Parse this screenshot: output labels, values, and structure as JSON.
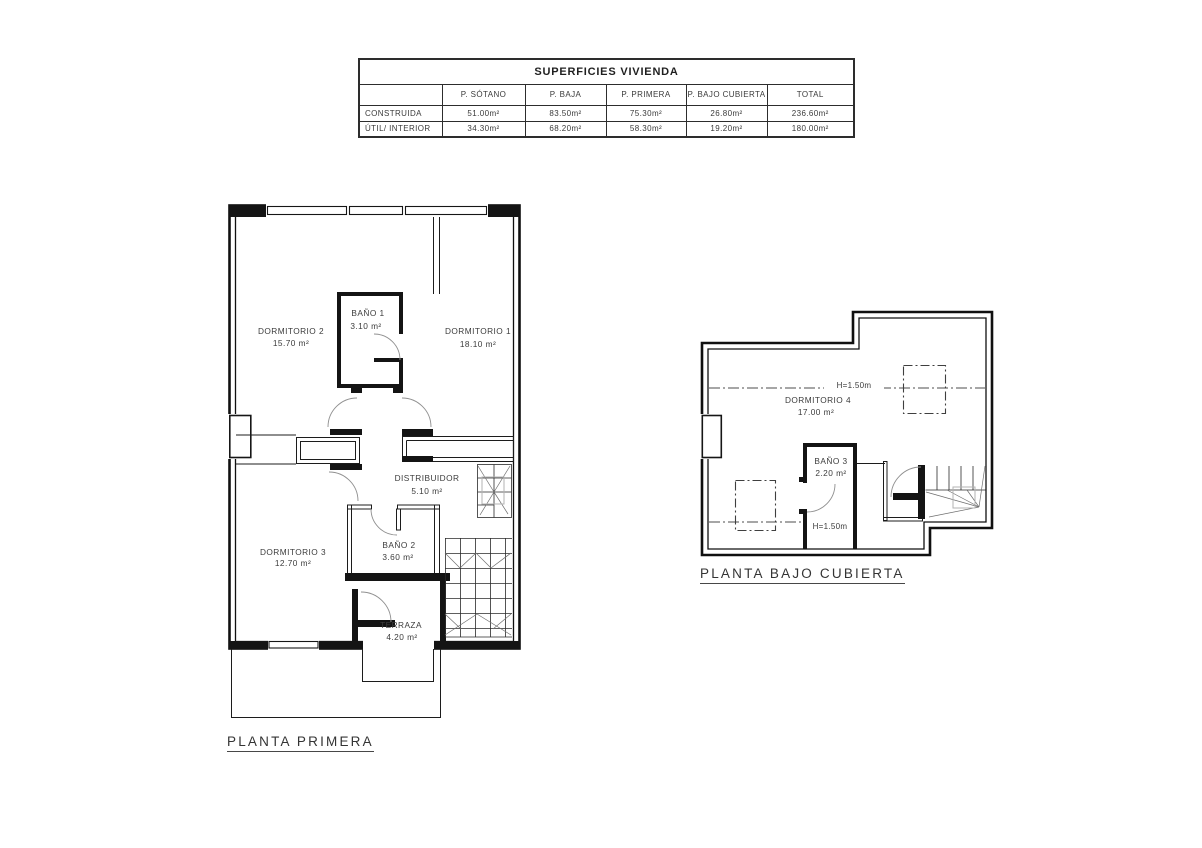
{
  "table": {
    "title": "SUPERFICIES VIVIENDA",
    "columns": [
      "P. SÓTANO",
      "P. BAJA",
      "P. PRIMERA",
      "P. BAJO CUBIERTA",
      "TOTAL"
    ],
    "rows": [
      {
        "label": "CONSTRUIDA",
        "values": [
          "51.00m²",
          "83.50m²",
          "75.30m²",
          "26.80m²",
          "236.60m²"
        ]
      },
      {
        "label": "ÚTIL/ INTERIOR",
        "values": [
          "34.30m²",
          "68.20m²",
          "58.30m²",
          "19.20m²",
          "180.00m²"
        ]
      }
    ]
  },
  "planta_primera": {
    "title": "PLANTA PRIMERA",
    "rooms": {
      "dormitorio2": {
        "name": "DORMITORIO 2",
        "area": "15.70 m²"
      },
      "bano1": {
        "name": "BAÑO 1",
        "area": "3.10 m²"
      },
      "dormitorio1": {
        "name": "DORMITORIO 1",
        "area": "18.10 m²"
      },
      "distribuidor": {
        "name": "DISTRIBUIDOR",
        "area": "5.10 m²"
      },
      "dormitorio3": {
        "name": "DORMITORIO 3",
        "area": "12.70 m²"
      },
      "bano2": {
        "name": "BAÑO 2",
        "area": "3.60 m²"
      },
      "terraza": {
        "name": "TERRAZA",
        "area": "4.20 m²"
      }
    }
  },
  "planta_bajo_cubierta": {
    "title": "PLANTA BAJO CUBIERTA",
    "rooms": {
      "dormitorio4": {
        "name": "DORMITORIO 4",
        "area": "17.00 m²"
      },
      "bano3": {
        "name": "BAÑO 3",
        "area": "2.20 m²"
      }
    },
    "annotations": {
      "height1": "H=1.50m",
      "height2": "H=1.50m"
    }
  },
  "colors": {
    "line": "#141414",
    "text": "#3c3c3c",
    "doorArc": "#8f8f8f"
  }
}
